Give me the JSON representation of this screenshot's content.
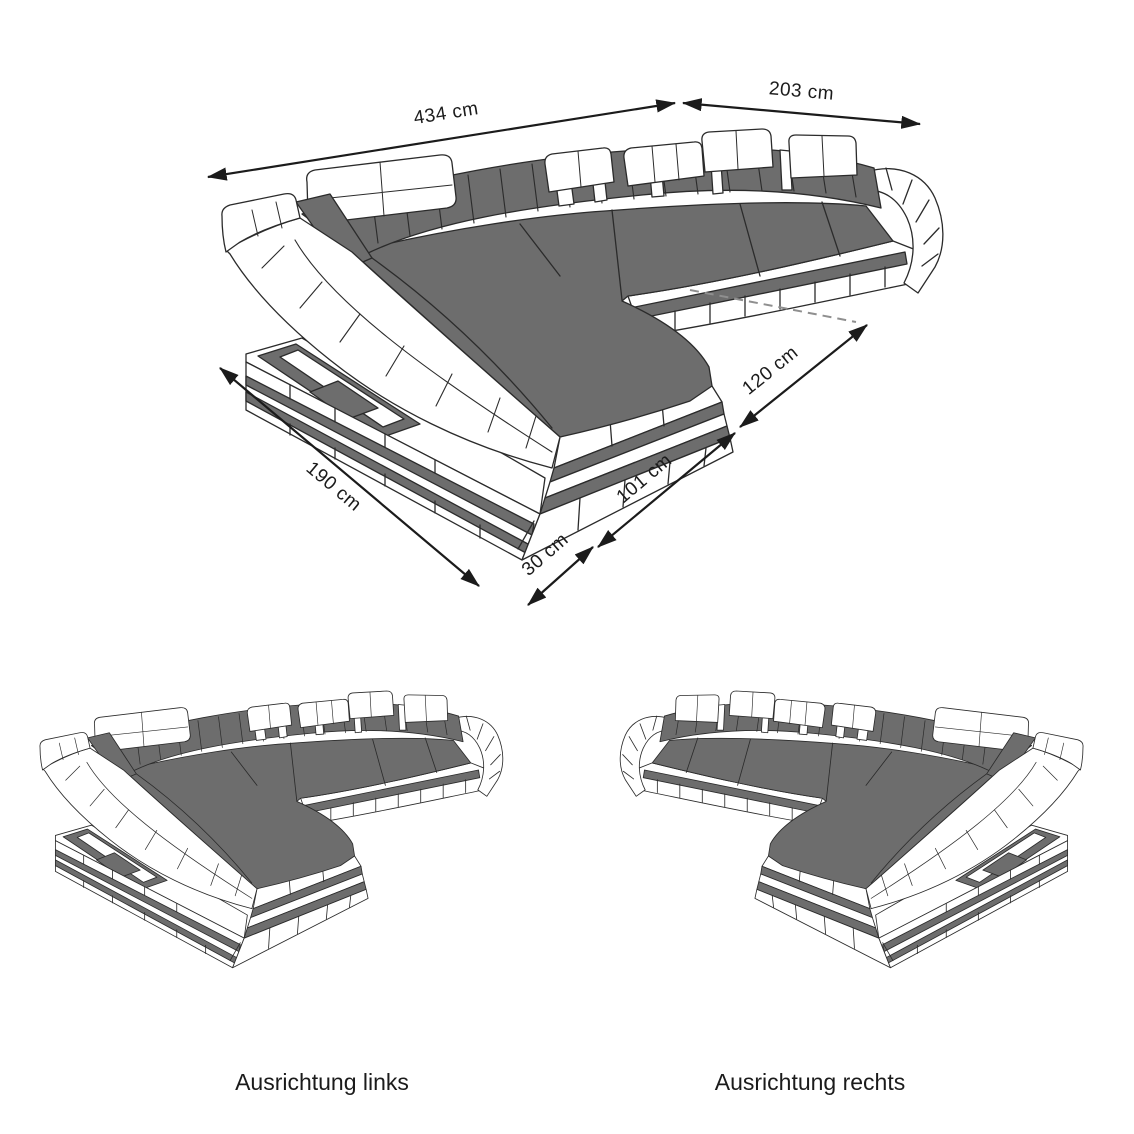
{
  "diagram": {
    "type": "furniture-dimension-diagram",
    "subject": "U-shaped sectional sofa with chaise, isometric line drawing",
    "colors": {
      "upholstery_gray": "#6d6d6d",
      "outline": "#2b2b2b",
      "body_white": "#ffffff",
      "dashed_line": "#8f8f8f",
      "background": "#ffffff"
    },
    "dimensions": {
      "back_width": "434 cm",
      "right_width": "203 cm",
      "depth": "190 cm",
      "front_corner": "30 cm",
      "chaise_front": "101 cm",
      "inner_notch": "120 cm"
    },
    "variants": {
      "left": {
        "caption": "Ausrichtung links"
      },
      "right": {
        "caption": "Ausrichtung rechts"
      }
    }
  }
}
